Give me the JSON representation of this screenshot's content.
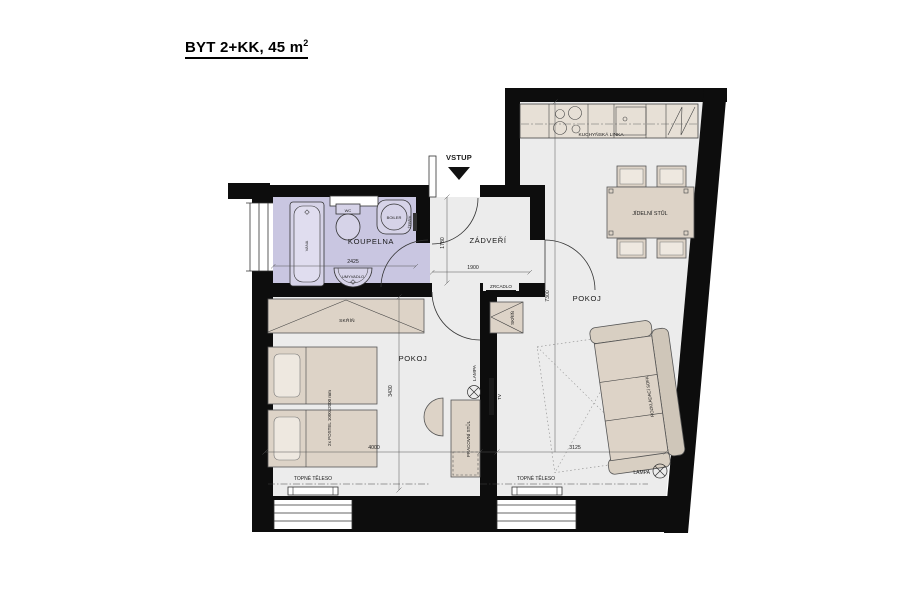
{
  "title": {
    "main": "BYT 2+KK, 45 m",
    "sup": "2"
  },
  "entrance": {
    "label": "VSTUP"
  },
  "bathroom": {
    "name": "KOUPELNA",
    "bathtub": "VANA",
    "toilet": "WC",
    "boiler": "BOILER",
    "sink": "UMYVADLO",
    "towel_rail": "ŽEBŘÍK",
    "width_dim": "2425"
  },
  "hallway": {
    "name": "ZÁDVEŘÍ",
    "mirror": "ZRCADLO",
    "depth_dim": "1780",
    "width_dim": "1900"
  },
  "bedroom": {
    "name": "POKOJ",
    "wardrobe": "SKŘÍŇ",
    "beds": "2x POSTEL 1000x2000 mm",
    "desk": "PRACOVNÍ STŮL",
    "lamp": "LAMPA",
    "radiator": "TOPNÉ TĚLESO",
    "depth_dim": "3430",
    "width_dim": "4000"
  },
  "living_room": {
    "name": "POKOJ",
    "kitchen": "KUCHYŇSKÁ LINKA",
    "dining_table": "JÍDELNÍ STŮL",
    "sofa": "ROZKLÁDACÍ SOFA",
    "wardrobe": "SKŘÍŇ",
    "tv": "TV",
    "lamp": "LAMPA",
    "radiator": "TOPNÉ TĚLESO",
    "depth_dim": "7300",
    "width_dim": "3125"
  },
  "colors": {
    "wall": "#0d0d0d",
    "floor": "#ececec",
    "bathroom_floor": "#c9c6e1",
    "furniture": "#ddd3c7"
  }
}
